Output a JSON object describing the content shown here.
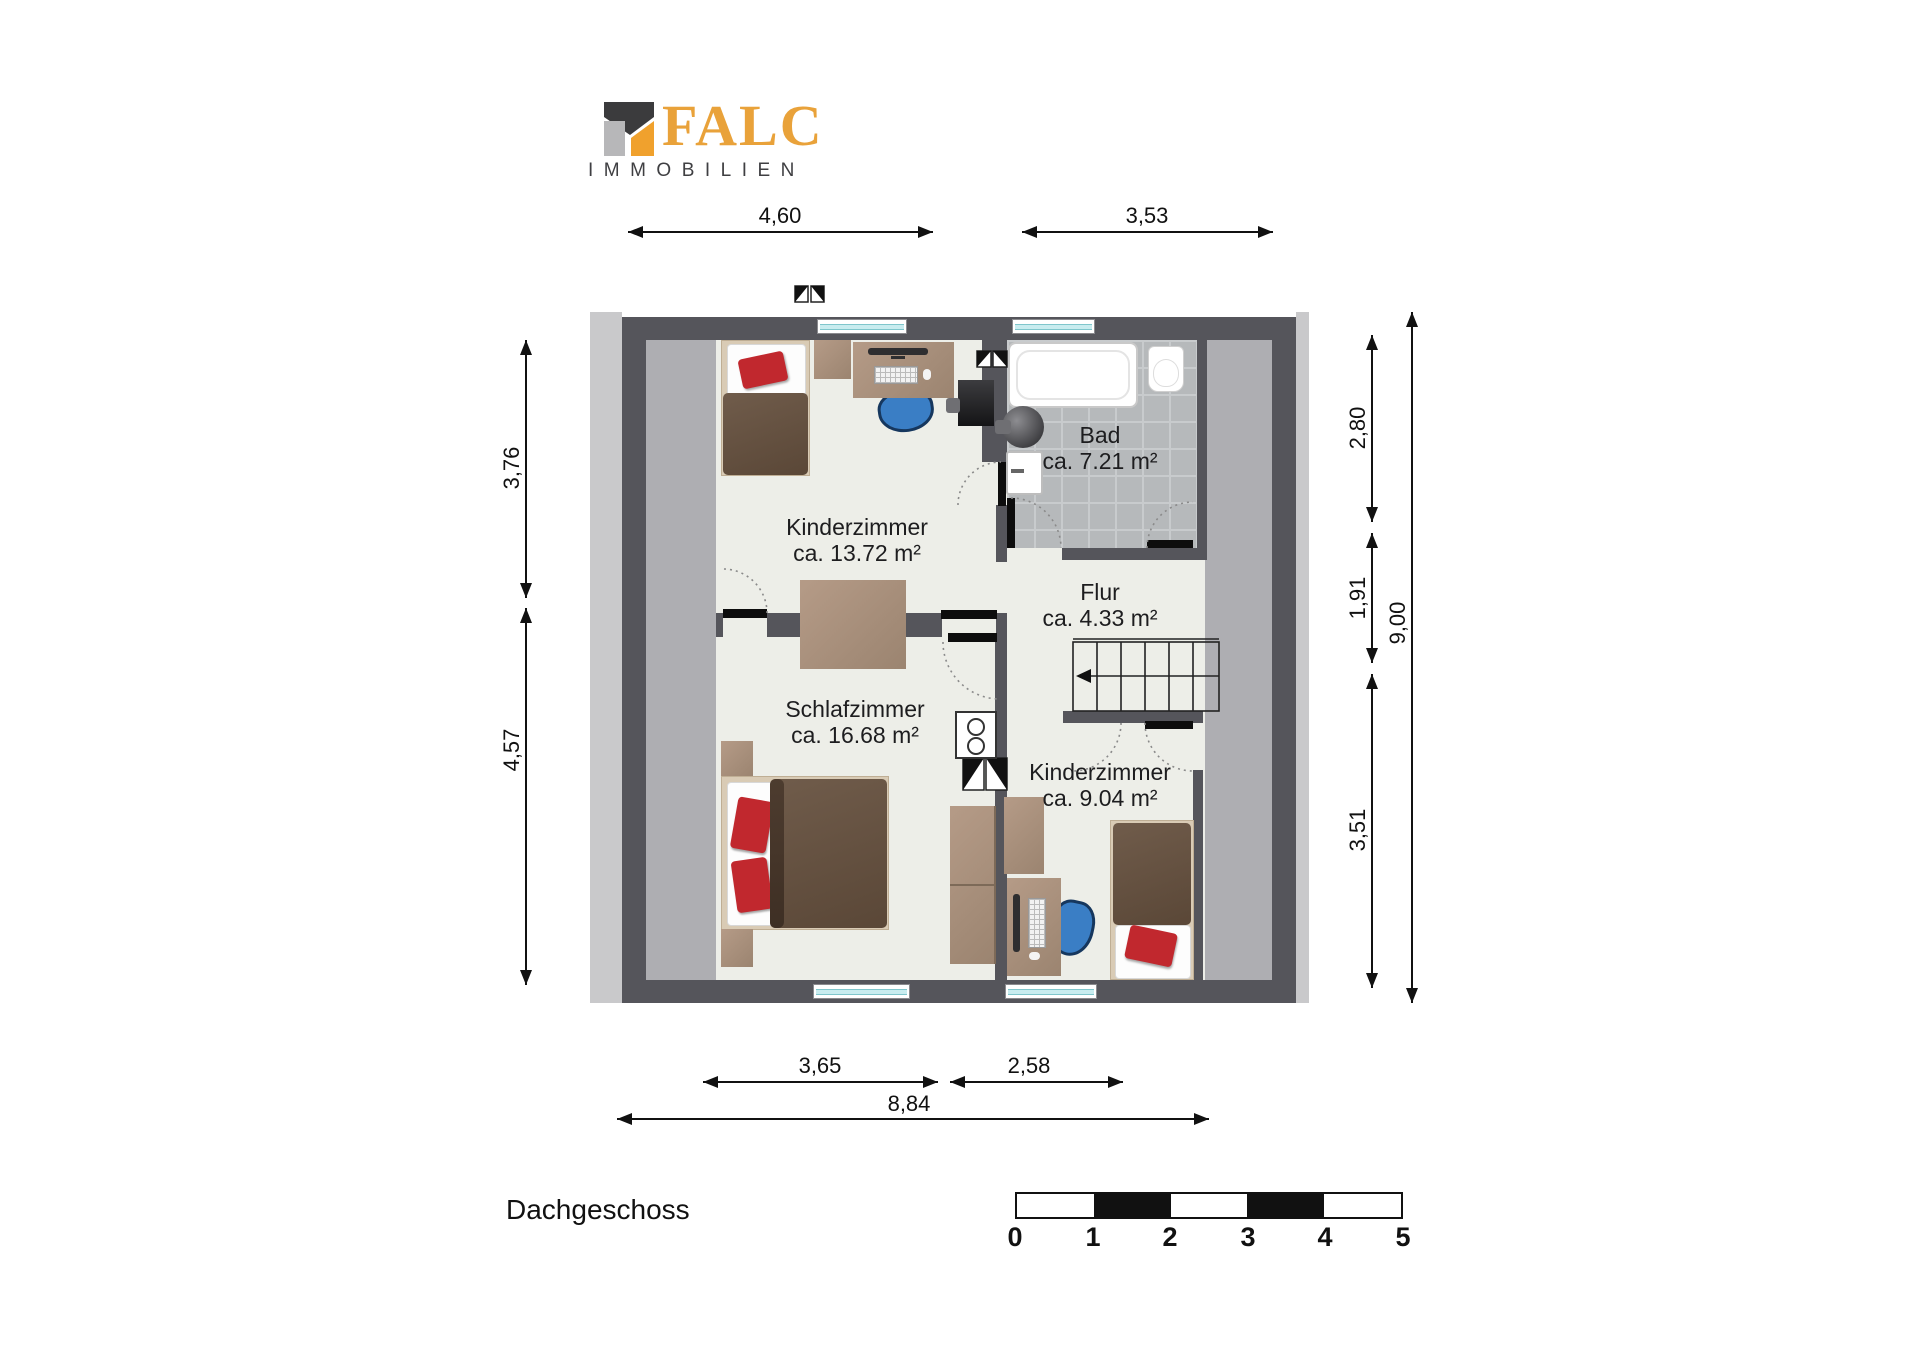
{
  "brand": {
    "name": "FALC",
    "subtitle": "IMMOBILIEN",
    "colors": {
      "orange": "#E9A23A",
      "dark_text": "#3F3F42",
      "mark_dark": "#3B3B3D",
      "mark_gray": "#B7B7B9",
      "mark_orange": "#F0A12D"
    }
  },
  "plan": {
    "floor_label": "Dachgeschoss",
    "rooms": [
      {
        "id": "kinderzimmer-1",
        "name": "Kinderzimmer",
        "area": "ca. 13.72 m²"
      },
      {
        "id": "bad",
        "name": "Bad",
        "area": "ca. 7.21 m²"
      },
      {
        "id": "flur",
        "name": "Flur",
        "area": "ca. 4.33 m²"
      },
      {
        "id": "schlafzimmer",
        "name": "Schlafzimmer",
        "area": "ca. 16.68 m²"
      },
      {
        "id": "kinderzimmer-2",
        "name": "Kinderzimmer",
        "area": "ca. 9.04 m²"
      }
    ],
    "dimensions": {
      "top_left": "4,60",
      "top_right": "3,53",
      "left_upper": "3,76",
      "left_lower": "4,57",
      "right_upper": "2,80",
      "right_middle": "1,91",
      "right_lower": "3,51",
      "right_total": "9,00",
      "bottom_left": "3,65",
      "bottom_right": "2,58",
      "bottom_total": "8,84"
    },
    "colors": {
      "wall": "#55555B",
      "floor": "#EDEEE8",
      "low_headroom": "#AEAEB2",
      "roof_edge": "#C9C9CB",
      "bath_tiles": "#B6B9BB",
      "accent_red": "#C1282E",
      "chair_blue": "#3A7EC5"
    }
  },
  "scale_bar": {
    "labels": [
      "0",
      "1",
      "2",
      "3",
      "4",
      "5"
    ]
  }
}
